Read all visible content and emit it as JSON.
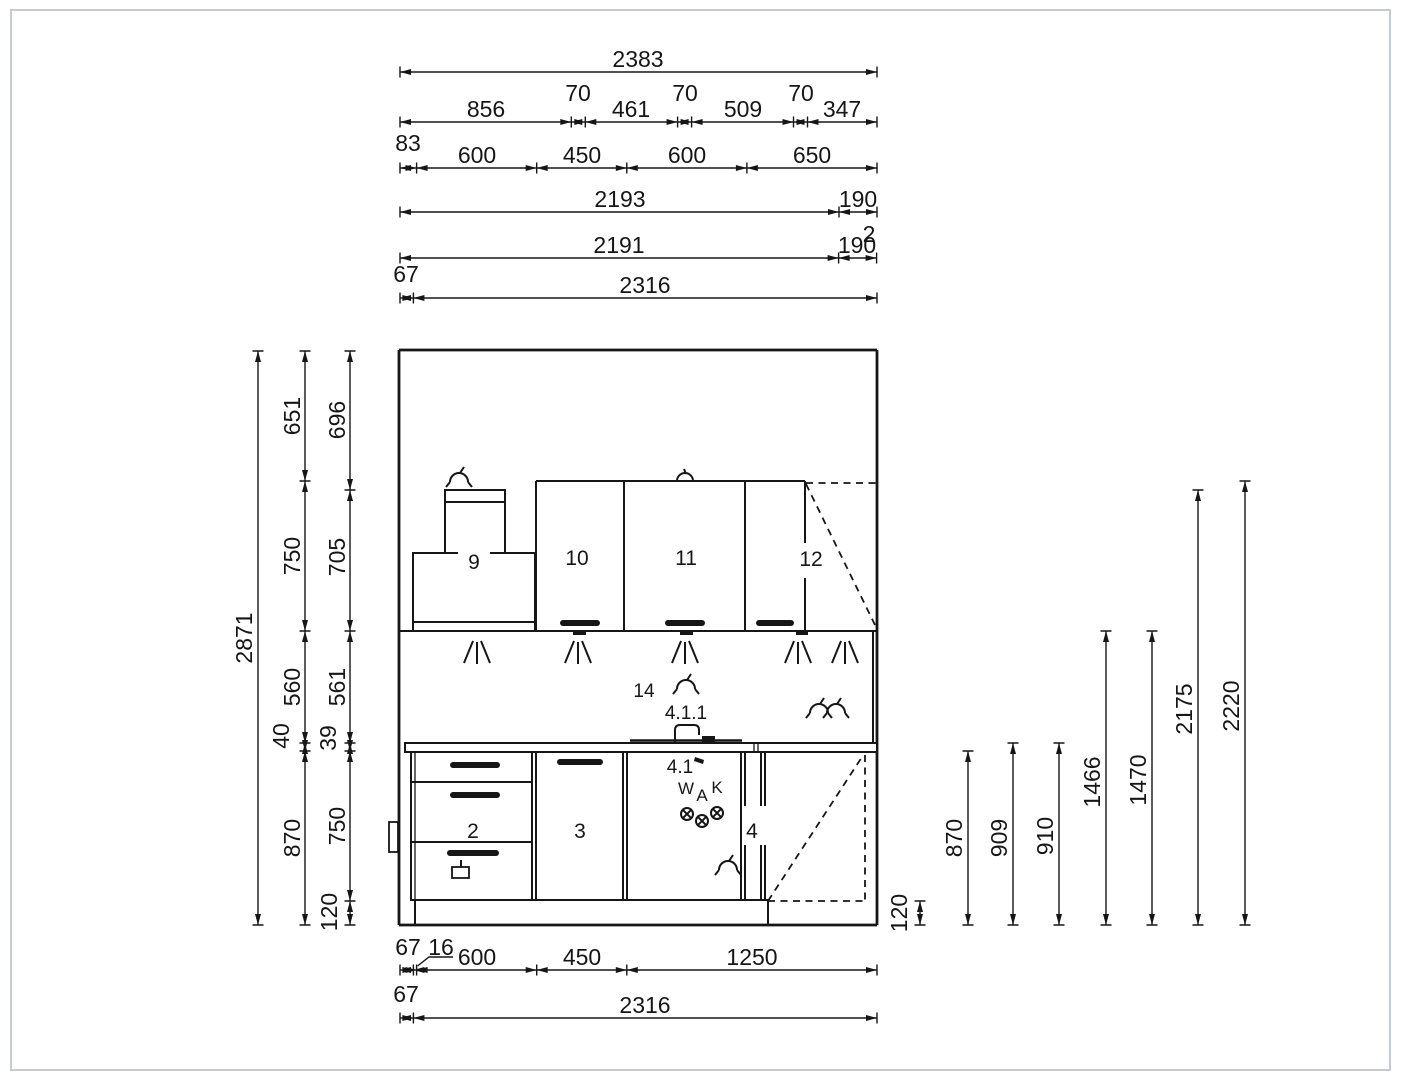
{
  "frame": {
    "border_color": "#c6cbd0",
    "background": "#ffffff",
    "ink": "#161616"
  },
  "dims_top": {
    "row1_total": "2383",
    "row2_segments": [
      "856",
      "70",
      "461",
      "70",
      "509",
      "70",
      "347"
    ],
    "row3_offset": "83",
    "row3_segments": [
      "600",
      "450",
      "600",
      "650"
    ],
    "row4_length": "2193",
    "row4_end": "190",
    "row5_length": "2191",
    "row5_end": "190",
    "row5_gap": "2",
    "row6_offset": "67",
    "row6_total": "2316"
  },
  "dims_left": {
    "total": "2871",
    "chain_a": [
      "651",
      "750",
      "560",
      "40",
      "870"
    ],
    "chain_b": [
      "696",
      "705",
      "561",
      "39",
      "750",
      "120"
    ]
  },
  "dims_right": {
    "plinth": "120",
    "heights": [
      "870",
      "909",
      "910",
      "1466",
      "1470",
      "2175",
      "2220"
    ]
  },
  "dims_bottom": {
    "row1_offset": "67",
    "row1_filler": "16",
    "row1_segments": [
      "600",
      "450",
      "1250"
    ],
    "row2_offset": "67",
    "row2_total": "2316"
  },
  "cabinets": {
    "hood": "9",
    "wall_cabinet_1": "10",
    "wall_cabinet_2": "11",
    "wall_corner_cabinet": "12",
    "niche": "14",
    "drawer_cabinet": "2",
    "door_cabinet": "3",
    "corner_cabinet": "4",
    "sink_cabinet": "4.1",
    "faucet": "4.1.1"
  },
  "plumbing": {
    "hot_water": "W",
    "drain": "A",
    "cold_water": "K"
  }
}
